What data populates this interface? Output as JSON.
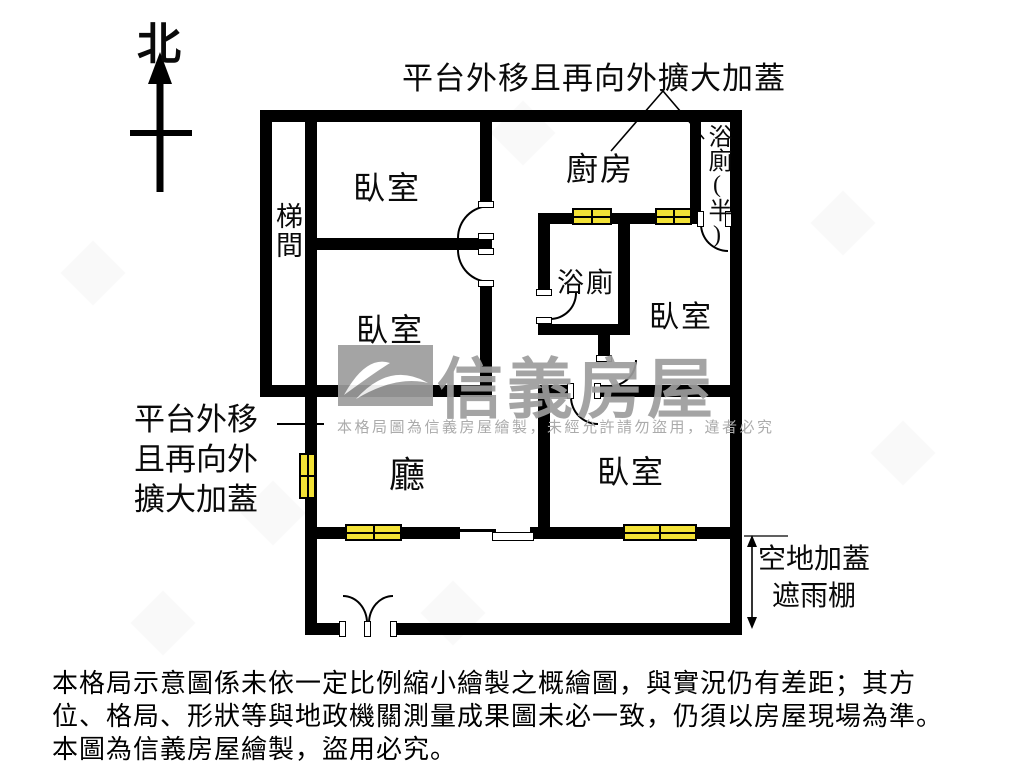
{
  "compass": {
    "label": "北"
  },
  "annotations": {
    "top": "平台外移且再向外擴大加蓋",
    "left_lines": [
      "平台外移",
      "且再向外",
      "擴大加蓋"
    ],
    "right_lines": [
      "空地加蓋",
      "遮雨棚"
    ]
  },
  "rooms": {
    "stairwell": "梯間",
    "bedroom_top_left": "臥室",
    "bedroom_mid_left": "臥室",
    "kitchen": "廚房",
    "half_bathroom": "浴廁(半)",
    "bathroom": "浴廁",
    "bedroom_right": "臥室",
    "living_room": "廳",
    "bedroom_bottom": "臥室"
  },
  "watermark": {
    "brand": "信義房屋",
    "notice": "本格局圖為信義房屋繪製，未經允許請勿盜用，違者必究"
  },
  "disclaimer_lines": [
    "本格局示意圖係未依一定比例縮小繪製之概繪圖，與實況仍有差距；其方",
    "位、格局、形狀等與地政機關測量成果圖未必一致，仍須以房屋現場為準。",
    "本圖為信義房屋繪製，盜用必究。"
  ],
  "colors": {
    "wall": "#000000",
    "window_fill": "#f2e136",
    "watermark_gray": "#9d9d9d"
  }
}
